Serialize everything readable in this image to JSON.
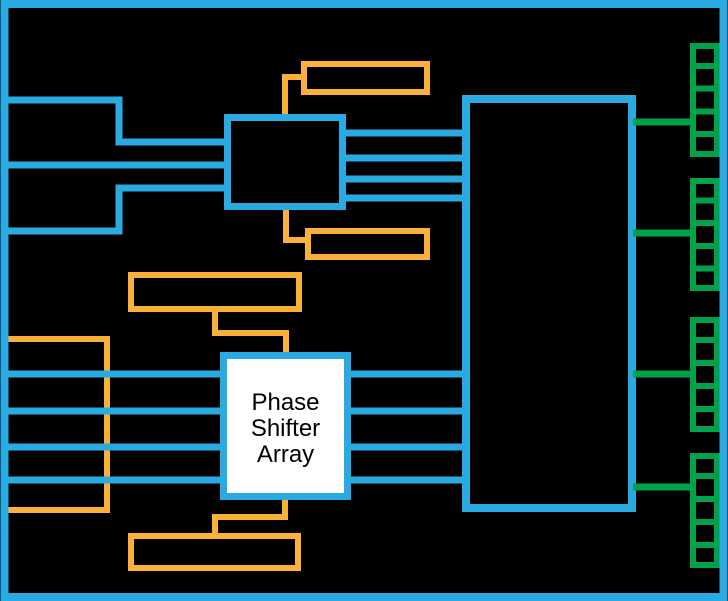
{
  "diagram": {
    "type": "block-diagram",
    "background": "#000000",
    "colors": {
      "background": "#000000",
      "cyan": "#29ABE2",
      "orange": "#FBB03B",
      "green": "#00A14B",
      "block_fill": "#000000",
      "psa_fill": "#FFFFFF",
      "psa_text": "#000000"
    },
    "blocks": {
      "phase_shifter_array": {
        "label": "Phase Shifter Array",
        "lines": [
          "Phase",
          "Shifter",
          "Array"
        ]
      }
    },
    "counts": {
      "input_lines": 3,
      "splitter_outputs": 4,
      "bus_lines": 4,
      "antenna_arrays": 4,
      "antenna_cells_per_array": 5
    }
  }
}
